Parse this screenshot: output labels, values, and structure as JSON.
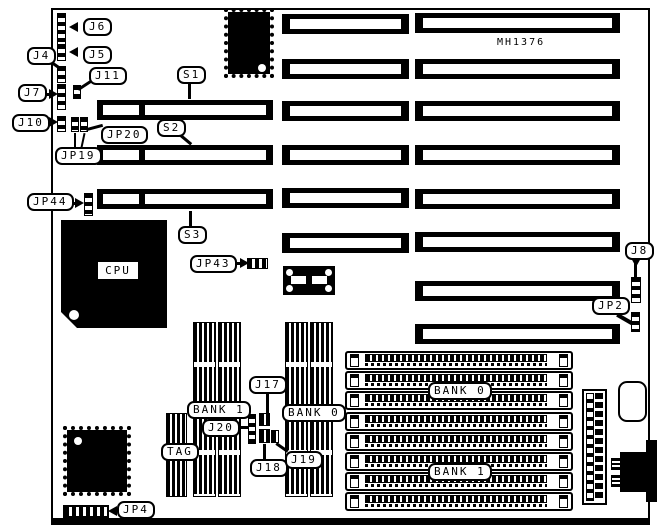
{
  "title": "Motherboard connector and jumper location diagram",
  "board": {
    "model": "MH1376",
    "cpu_label": "CPU"
  },
  "labels": {
    "j6": "J6",
    "j5": "J5",
    "j4": "J4",
    "j11": "J11",
    "j7": "J7",
    "j10": "J10",
    "jp20": "JP20",
    "jp19": "JP19",
    "s1": "S1",
    "s2": "S2",
    "s3": "S3",
    "jp44": "JP44",
    "jp43": "JP43",
    "j8": "J8",
    "jp2": "JP2",
    "jp4": "JP4",
    "j17": "J17",
    "j20": "J20",
    "tag": "TAG",
    "j18": "J18",
    "j19": "J19",
    "bank1_dip": "BANK 1",
    "bank0_dip": "BANK 0",
    "bank0_simm": "BANK 0",
    "bank1_simm": "BANK 1"
  },
  "colors": {
    "ink": "#000000",
    "paper": "#ffffff"
  }
}
